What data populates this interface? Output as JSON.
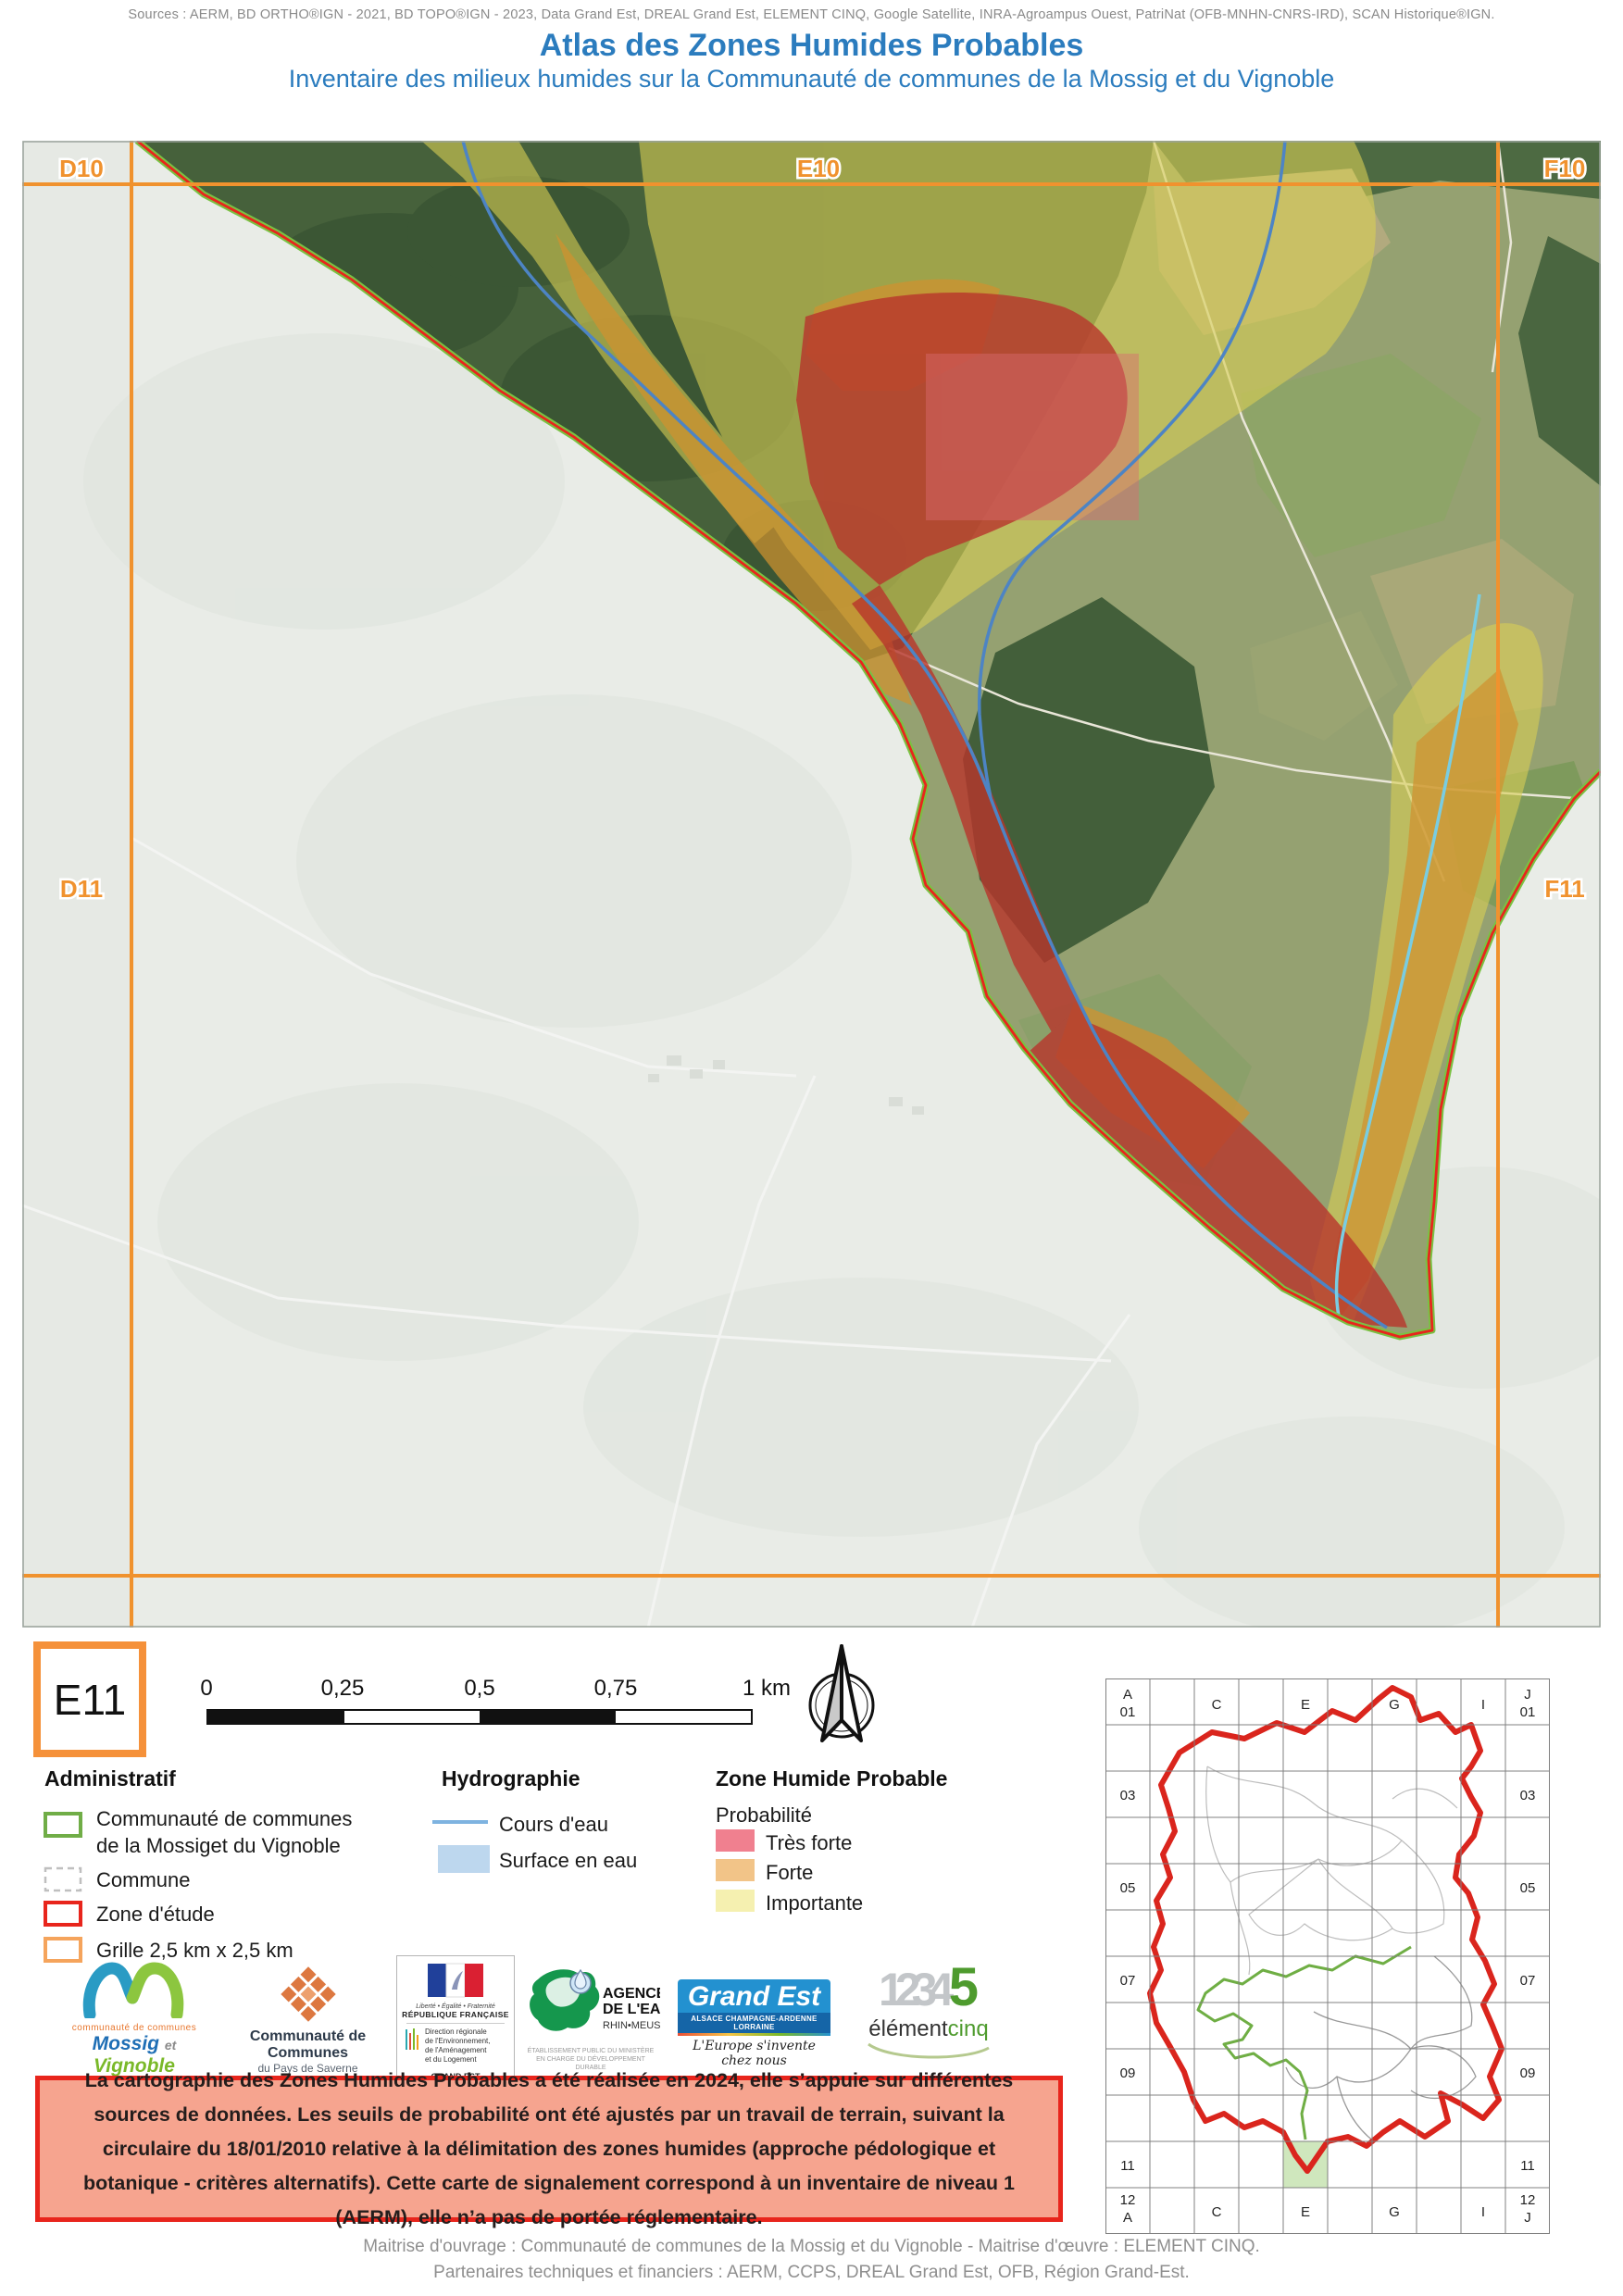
{
  "header": {
    "sources": "Sources : AERM, BD ORTHO®IGN - 2021, BD TOPO®IGN - 2023, Data Grand Est, DREAL Grand Est, ELEMENT CINQ, Google Satellite, INRA-Agroampus Ouest, PatriNat (OFB-MNHN-CNRS-IRD), SCAN Historique®IGN.",
    "title": "Atlas des Zones Humides Probables",
    "subtitle": "Inventaire des milieux humides sur la Communauté de communes de la Mossig et du Vignoble",
    "accent_blue": "#2B7CBE"
  },
  "map": {
    "tile_code": "E11",
    "grid_labels": {
      "top_left": "D10",
      "top_center": "E10",
      "top_right": "F10",
      "mid_left": "D11",
      "mid_right": "F11"
    },
    "colors": {
      "grid": "#F0922E",
      "boundary_red": "#E8251C",
      "boundary_green": "#7AC143",
      "stream": "#4D84C4",
      "stream_light": "#79CDE2",
      "tres_forte": "#B8352C",
      "forte": "#D0922F",
      "importante": "#D8CE55"
    }
  },
  "scalebar": {
    "ticks": [
      "0",
      "0,25",
      "0,5",
      "0,75",
      "1 km"
    ]
  },
  "legend": {
    "administratif": {
      "title": "Administratif",
      "items": [
        {
          "label": "Communauté de communes",
          "label2": "de la Mossiget du Vignoble",
          "color": "#70AD47"
        },
        {
          "label": "Commune",
          "color": "#BFBFBF"
        },
        {
          "label": "Zone d'étude",
          "color": "#E8251C"
        },
        {
          "label": "Grille 2,5 km x 2,5 km",
          "color": "#F5A45C"
        }
      ]
    },
    "hydrographie": {
      "title": "Hydrographie",
      "items": [
        {
          "label": "Cours d'eau",
          "color": "#7EB3E0"
        },
        {
          "label": "Surface en eau",
          "color": "#BDD7EE"
        }
      ]
    },
    "zone_humide": {
      "title": "Zone Humide Probable",
      "subtitle": "Probabilité",
      "items": [
        {
          "label": "Très forte",
          "color": "#F0808F"
        },
        {
          "label": "Forte",
          "color": "#F2C488"
        },
        {
          "label": "Importante",
          "color": "#F5F0B0"
        }
      ]
    }
  },
  "logos": {
    "mossig": {
      "cap": "communauté de communes",
      "name1": "Mossig",
      "et": "et",
      "name2": "Vignoble",
      "region": "Alsace"
    },
    "saverne": {
      "line1": "Communauté de Communes",
      "line2": "du Pays de Saverne"
    },
    "dreal": {
      "motto": "Liberté • Égalité • Fraternité",
      "republique": "RÉPUBLIQUE FRANÇAISE",
      "l1": "Direction régionale",
      "l2": "de l'Environnement,",
      "l3": "de l'Aménagement",
      "l4": "et du Logement",
      "footer": "GRAND EST"
    },
    "agence": {
      "l1": "AGENCE",
      "l2": "DE L'EAU",
      "l3": "RHIN•MEUSE",
      "sub1": "ÉTABLISSEMENT PUBLIC DU MINISTÈRE",
      "sub2": "EN CHARGE DU DÉVELOPPEMENT DURABLE"
    },
    "grandest": {
      "name": "Grand Est",
      "band": "ALSACE CHAMPAGNE-ARDENNE LORRAINE",
      "tagline": "L'Europe s'invente chez nous"
    },
    "elementcinq": {
      "digits": "1234",
      "five": "5",
      "name1": "élément",
      "name2": "cinq"
    }
  },
  "notice": {
    "text": "La cartographie des Zones Humides Probables a été réalisée en 2024, elle s’appuie sur différentes sources de données. Les seuils de probabilité ont été ajustés par un travail de terrain, suivant la circulaire du 18/01/2010 relative à la délimitation des zones humides (approche pédologique et botanique - critères alternatifs). Cette carte de signalement correspond à un inventaire de niveau 1 (AERM), elle n’a pas de portée réglementaire."
  },
  "credits": {
    "line1": "Maitrise d'ouvrage : Communauté de communes de la Mossig et du Vignoble - Maitrise d'œuvre : ELEMENT CINQ.",
    "line2": "Partenaires techniques et financiers : AERM, CCPS, DREAL Grand Est, OFB, Région Grand-Est."
  },
  "overview": {
    "corner_tl1": "A",
    "corner_tl2": "01",
    "corner_tr1": "J",
    "corner_tr2": "01",
    "corner_bl1": "12",
    "corner_bl2": "A",
    "corner_br1": "12",
    "corner_br2": "J",
    "cols": [
      "C",
      "E",
      "G",
      "I"
    ],
    "rows": [
      "03",
      "05",
      "07",
      "09",
      "11"
    ],
    "highlight_color": "#CFE7BD"
  }
}
